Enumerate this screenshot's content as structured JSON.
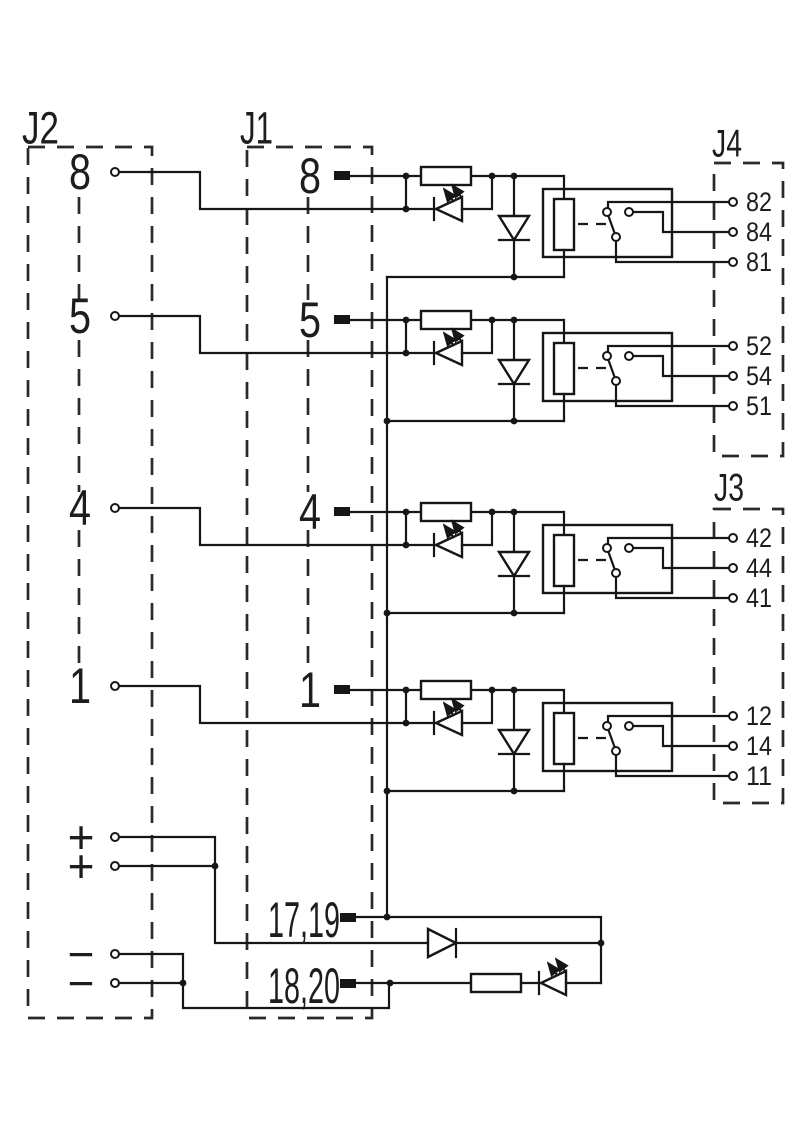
{
  "colors": {
    "line": "#161616",
    "background": "#ffffff"
  },
  "connectors": {
    "j2": {
      "label": "J2",
      "power_pins": [
        "+",
        "+",
        "−",
        "−"
      ]
    },
    "j1": {
      "label": "J1",
      "supply_pins": [
        "17,19",
        "18,20"
      ]
    },
    "j4": {
      "label": "J4"
    },
    "j3": {
      "label": "J3"
    }
  },
  "channels": [
    {
      "j1_input": "8",
      "j2_parallel": "8",
      "output_connector": "J4",
      "contacts": {
        "nc": "82",
        "no": "84",
        "common": "81"
      }
    },
    {
      "j1_input": "5",
      "j2_parallel": "5",
      "output_connector": "J4",
      "contacts": {
        "nc": "52",
        "no": "54",
        "common": "51"
      }
    },
    {
      "j1_input": "4",
      "j2_parallel": "4",
      "output_connector": "J3",
      "contacts": {
        "nc": "42",
        "no": "44",
        "common": "41"
      }
    },
    {
      "j1_input": "1",
      "j2_parallel": "1",
      "output_connector": "J3",
      "contacts": {
        "nc": "12",
        "no": "14",
        "common": "11"
      }
    }
  ]
}
